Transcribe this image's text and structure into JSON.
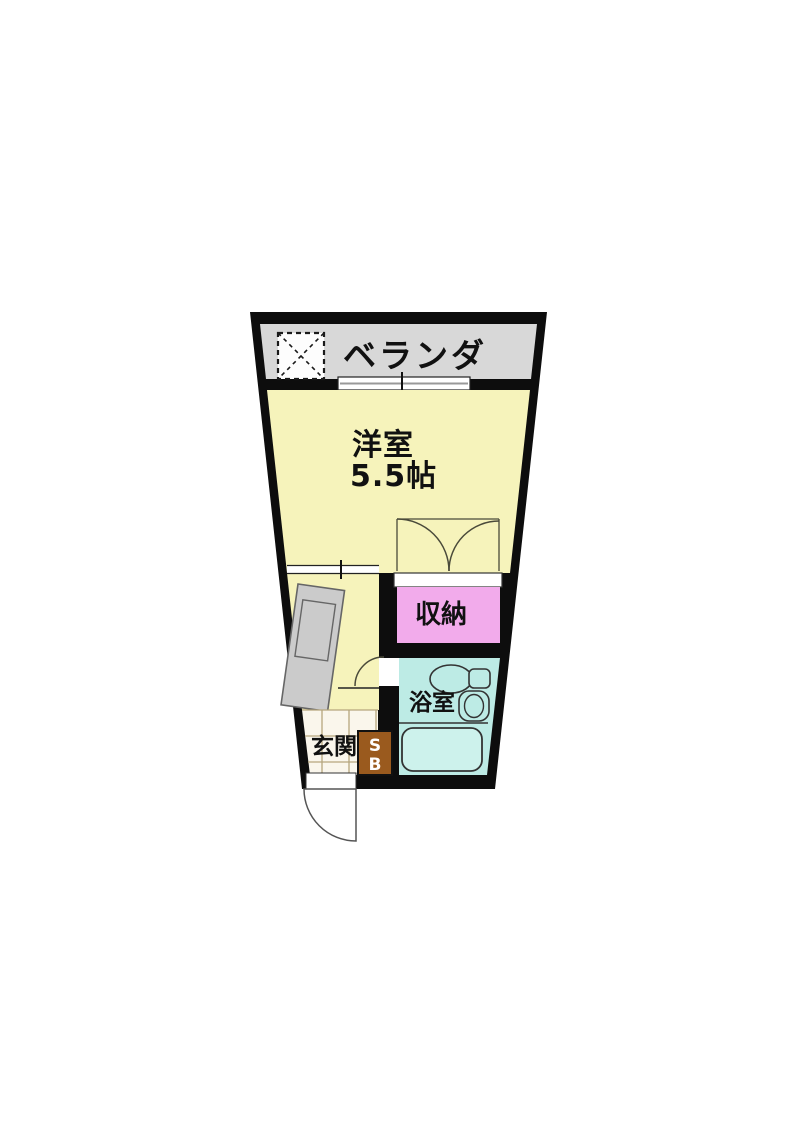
{
  "figure": {
    "kind": "apartment-floor-plan"
  },
  "labels": {
    "balcony": "ベランダ",
    "main_room_name": "洋室",
    "main_room_size": "5.5帖",
    "closet": "収納",
    "bathroom": "浴室",
    "entrance": "玄関",
    "shoebox_line1": "S",
    "shoebox_line2": "B"
  },
  "colors": {
    "wall": "#0d0d0d",
    "balcony": "#d8d8d8",
    "room": "#f6f3bb",
    "closet": "#f2abeb",
    "bath": "#bdebe5",
    "bathtub": "#cdf2ec",
    "kitchen_counter": "#cbcbcb",
    "shoebox": "#9a5a1e",
    "entrance_floor": "#faf6ec",
    "entrance_grid": "#b6a67e",
    "fixture_line": "#333333",
    "door_line": "#4a4a3a",
    "white": "#ffffff",
    "window_gray": "#999999",
    "page_background": "#ffffff"
  }
}
